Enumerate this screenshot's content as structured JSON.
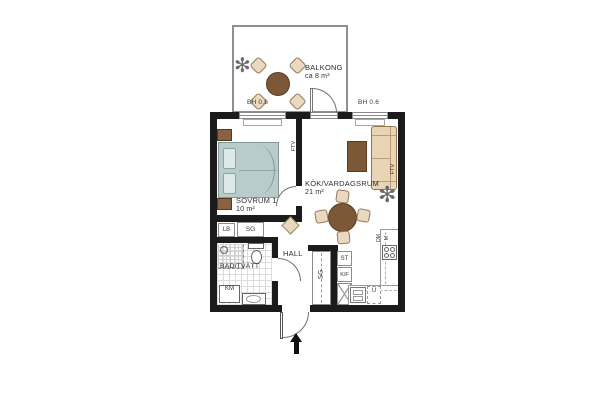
{
  "plan": {
    "balcony": {
      "name": "BALKONG",
      "area": "ca 8 m²"
    },
    "bedroom": {
      "name": "SOVRUM 1",
      "area": "10 m²"
    },
    "living": {
      "name": "KÖK/VARDAGSRUM",
      "area": "21 m²"
    },
    "hall": {
      "name": "HALL"
    },
    "bath": {
      "name": "BAD/TVÄTT"
    },
    "sill_labels": {
      "left": "BH 0.6",
      "right": "BH 0.6"
    },
    "fixtures": {
      "lb": "LB",
      "sg_hall": "SG",
      "km": "KM",
      "sg_kitchen": "SG",
      "st": "ST",
      "kf": "K/F",
      "dm": "DM",
      "m": "M",
      "u": "U",
      "ftv_bedroom_wall": "FTV",
      "ftv_living_wall": "FTV"
    }
  },
  "colors": {
    "wall": "#1b1b1b",
    "balcony_rail": "#8f8f8f",
    "wood": "#7d5837",
    "upholstery": "#ead9bf",
    "bed": "#b9cbca",
    "sofa": "#e9d4b5"
  }
}
